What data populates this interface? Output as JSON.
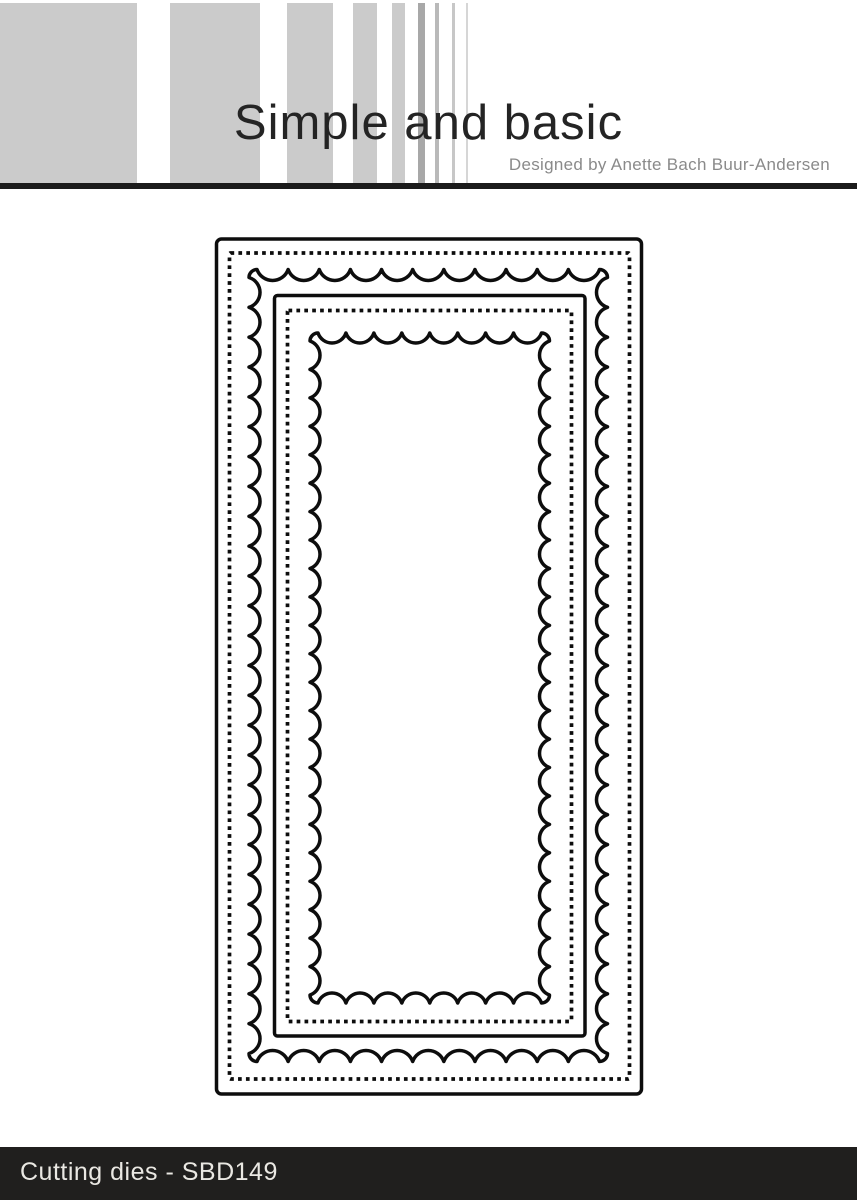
{
  "header": {
    "brand": "Simple and basic",
    "designer_credit": "Designed by Anette Bach Buur-Andersen"
  },
  "footer": {
    "label": "Cutting dies - SBD149"
  },
  "colors": {
    "stripe_gray": "#cbcbcb",
    "header_bar": "#1b1b1b",
    "footer_bg": "#201f1e",
    "footer_text": "#eae8e3",
    "designer_text": "#8a8a8a",
    "title_text": "#242424",
    "die_line": "#0d0d0d",
    "page_bg": "#ffffff"
  },
  "decor": {
    "stripes": [
      {
        "x": 0,
        "w": 137,
        "c": "#cbcbcb"
      },
      {
        "x": 170,
        "w": 90,
        "c": "#cbcbcb"
      },
      {
        "x": 287,
        "w": 46,
        "c": "#cbcbcb"
      },
      {
        "x": 353,
        "w": 24,
        "c": "#cbcbcb"
      },
      {
        "x": 392,
        "w": 13,
        "c": "#cbcbcb"
      },
      {
        "x": 418,
        "w": 7,
        "c": "#a8a8a8"
      },
      {
        "x": 435,
        "w": 4,
        "c": "#b9b9b9"
      },
      {
        "x": 452,
        "w": 2.5,
        "c": "#c7c7c7"
      },
      {
        "x": 466,
        "w": 2,
        "c": "#d6d6d6"
      }
    ]
  },
  "die_diagram": {
    "viewbox": "0 0 430 861",
    "dash": "3.7 4.2",
    "frames": [
      {
        "name": "outer-cut-frame",
        "kind": "solid",
        "x": 2.5,
        "y": 3,
        "w": 425,
        "h": 855,
        "rx": 5,
        "sw": 3.5
      },
      {
        "name": "outer-stitch-line",
        "kind": "dotted",
        "x": 15.5,
        "y": 17,
        "w": 400,
        "h": 826,
        "rx": 1,
        "sw": 3.7
      },
      {
        "name": "outer-scallop-frame",
        "kind": "scallop",
        "x0": 35,
        "y0": 33.5,
        "x1": 393.5,
        "y1": 825.5,
        "period": 30,
        "depth": 11,
        "corner": 8,
        "sw": 3.5
      },
      {
        "name": "inner-cut-frame",
        "kind": "solid",
        "x": 60.5,
        "y": 59.5,
        "w": 310.5,
        "h": 740.5,
        "rx": 3,
        "sw": 3.5
      },
      {
        "name": "inner-stitch-line",
        "kind": "dotted",
        "x": 73.5,
        "y": 74.5,
        "w": 284,
        "h": 711,
        "rx": 1,
        "sw": 3.7
      },
      {
        "name": "inner-scallop-frame",
        "kind": "scallop",
        "x0": 96,
        "y0": 97,
        "x1": 335.5,
        "y1": 767,
        "period": 28,
        "depth": 10,
        "corner": 8,
        "sw": 3.5
      }
    ]
  }
}
